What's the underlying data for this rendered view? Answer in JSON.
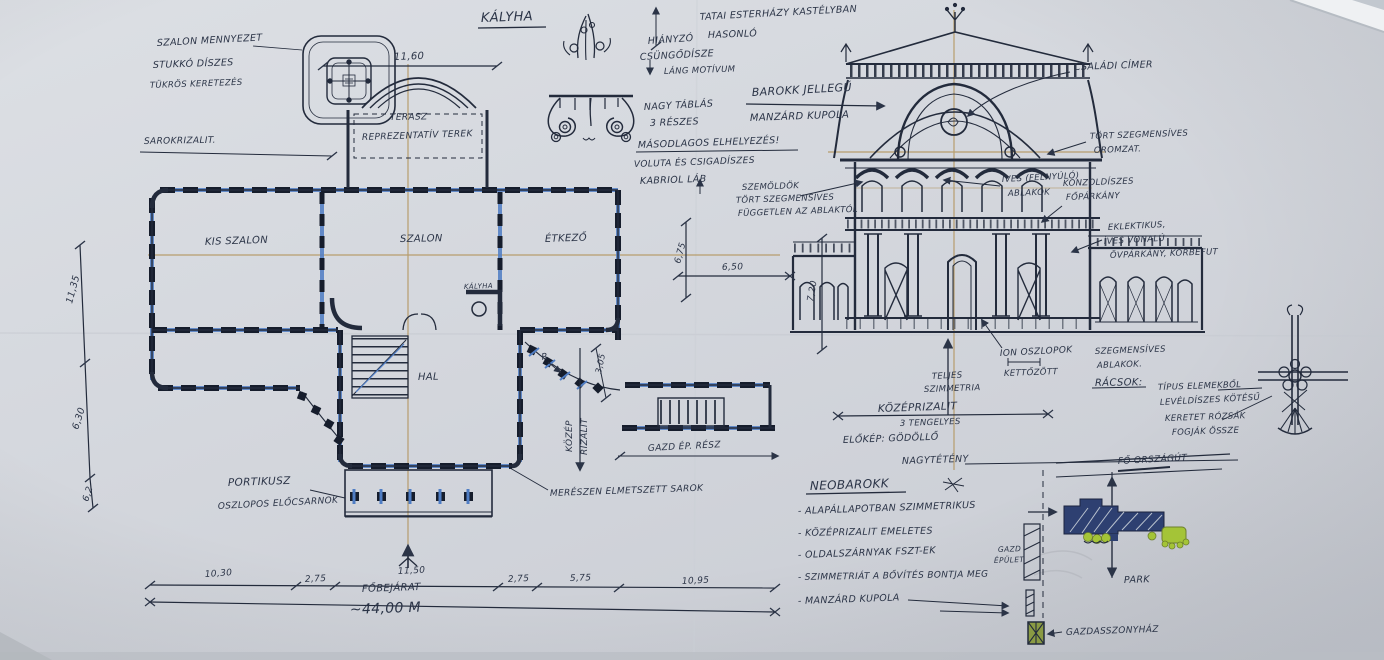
{
  "colors": {
    "paper": "#d5d8de",
    "ink": "#232b3c",
    "handwriting": "#2b3447",
    "construction_tan": "#b2935a",
    "highlight_blue": "#4f7dc4",
    "site_navy": "#2e4071",
    "site_green": "#a4c437",
    "site_olive": "#8a9a43"
  },
  "header": {
    "kalyha_title": "KÁLYHA",
    "tatai1": "TATAI ESTERHÁZY KASTÉLYBAN",
    "tatai2": "HASONLÓ"
  },
  "ceiling": {
    "l1": "SZALON MENNYEZET",
    "l2": "STUKKÓ DÍSZES",
    "l3": "TÜKRÖS KERETEZÉS"
  },
  "stove": {
    "hianyzo": "HIÁNYZÓ",
    "csungodisz": "CSÜNGŐDÍSZE",
    "lang": "LÁNG MOTÍVUM",
    "nagytablas": "NAGY TÁBLÁS",
    "reszes": "3 RÉSZES",
    "masodlagos": "MÁSODLAGOS ELHELYEZÉS!",
    "voluta": "VOLUTA ÉS CSIGADÍSZES",
    "kabriol": "KABRIOL LÁB"
  },
  "plan": {
    "sarokrizalit": "SAROKRIZALIT.",
    "terasz": "TERASZ",
    "reprezentativ": "REPREZENTATÍV TEREK",
    "kis_szalon": "KIS SZALON",
    "szalon": "SZALON",
    "etkezo": "ÉTKEZŐ",
    "hall": "HAL",
    "kalyha": "KÁLYHA",
    "r_label": "R",
    "portikusz": "PORTIKUSZ",
    "oszlopos": "OSZLOPOS ELŐCSARNOK",
    "fobejarat": "FŐBEJÁRAT",
    "kozep": "KÖZÉP",
    "rizalit": "RIZALIT",
    "sarok_note": "MERÉSZEN ELMETSZETT SAROK",
    "gazd_ep": "GAZD ÉP. RÉSZ"
  },
  "dims": {
    "terasz_w": "11,60",
    "left1": "11,35",
    "left2": "6,30",
    "left3": "6,2",
    "w1": "10,30",
    "w2": "2,75",
    "w3": "11,50",
    "w4": "2,75",
    "w5": "5,75",
    "w6": "10,95",
    "total": "~44,00 M",
    "rizalit_d": "3,05",
    "d675": "6,75",
    "d650": "6,50",
    "height": "7,20"
  },
  "elevation": {
    "barokk1": "BAROKK JELLEGŰ",
    "barokk2": "MANZÁRD KUPOLA",
    "szemoldok1": "SZEMÖLDÖK",
    "szemoldok2": "TÖRT SZEGMENSÍVES",
    "szemoldok3": "FÜGGETLEN AZ ABLAKTÓL",
    "cimer": "CSALÁDI CÍMER",
    "oromzat1": "TÖRT SZEGMENSÍVES",
    "oromzat2": "OROMZAT.",
    "felnyulo1": "ÍVES (FELNYÚLÓ)",
    "felnyulo2": "ABLAKOK",
    "konzol1": "KONZOLDÍSZES",
    "konzol2": "FŐPÁRKÁNY",
    "eklektikus1": "EKLEKTIKUS,",
    "eklektikus2": "ÍVES VONALÚ",
    "eklektikus3": "ÖVPÁRKÁNY, KÖRBEFUT",
    "ion1": "ION OSZLOPOK",
    "ion2": "KETTŐZÖTT",
    "teljes1": "TELJES",
    "teljes2": "SZIMMETRIA",
    "kozeprizalit": "KÖZÉPRIZALIT",
    "tengelyes": "3 TENGELYES",
    "elokep": "ELŐKÉP: GÖDÖLLŐ",
    "nagyteteny": "NAGYTÉTÉNY",
    "szegmens1": "SZEGMENSÍVES",
    "szegmens2": "ABLAKOK.",
    "racsok": "RÁCSOK:",
    "racs1": "TÍPUS ELEMEKBŐL",
    "racs2": "LEVÉLDÍSZES KÖTÉSŰ",
    "racs3": "KERETET RÓZSÁK",
    "racs4": "FOGJÁK ÖSSZE"
  },
  "notes": {
    "title": "NEOBAROKK",
    "items": [
      "- ALAPÁLLAPOTBAN SZIMMETRIKUS",
      "- KÖZÉPRIZALIT EMELETES",
      "- OLDALSZÁRNYAK FSZT-EK",
      "- SZIMMETRIÁT A BŐVÍTÉS BONTJA MEG",
      "- MANZÁRD KUPOLA"
    ]
  },
  "site": {
    "fo_orszagut": "FŐ ORSZÁGÚT",
    "park": "PARK",
    "gazd1": "GAZD",
    "gazd2": "ÉPÜLET",
    "gazdasszonyhaz": "GAZDASSZONYHÁZ"
  }
}
